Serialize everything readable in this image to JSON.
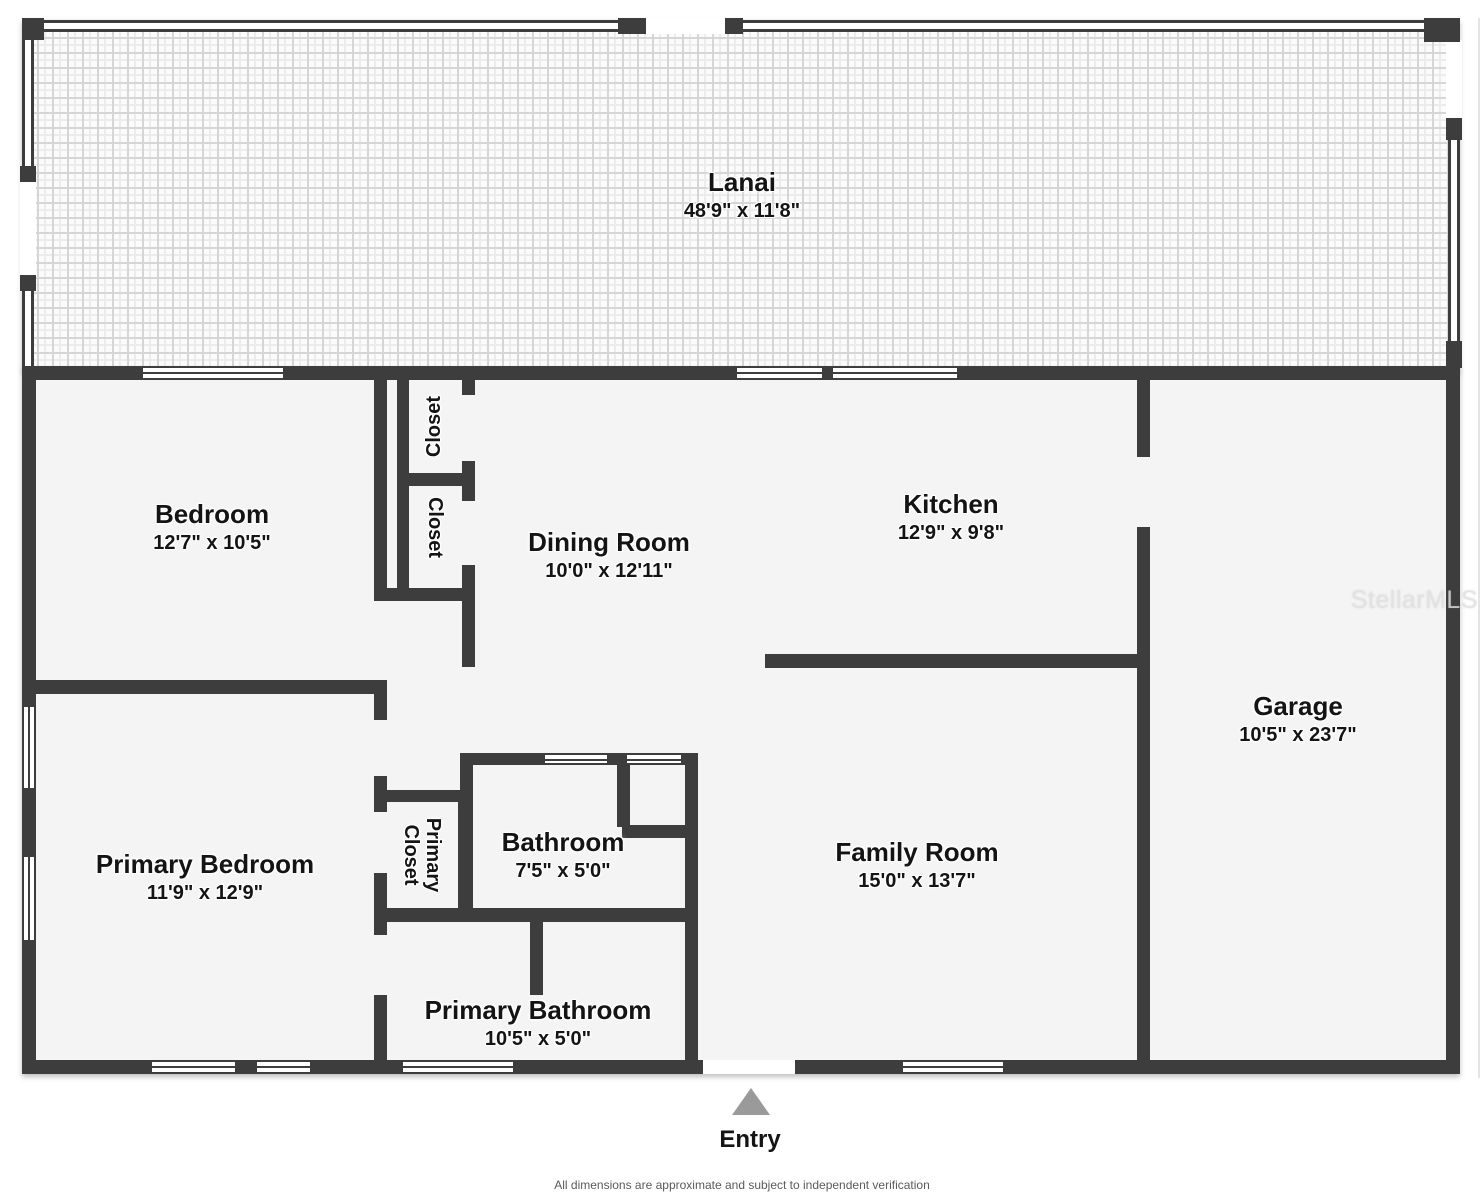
{
  "plan": {
    "watermark": "StellarMLS",
    "entry_label": "Entry",
    "disclaimer": "All dimensions are approximate and subject to independent verification"
  },
  "rooms": {
    "lanai": {
      "name": "Lanai",
      "dims": "48'9\" x 11'8\""
    },
    "bedroom": {
      "name": "Bedroom",
      "dims": "12'7\" x 10'5\""
    },
    "dining": {
      "name": "Dining Room",
      "dims": "10'0\" x 12'11\""
    },
    "kitchen": {
      "name": "Kitchen",
      "dims": "12'9\" x 9'8\""
    },
    "garage": {
      "name": "Garage",
      "dims": "10'5\" x 23'7\""
    },
    "primary_bedroom": {
      "name": "Primary Bedroom",
      "dims": "11'9\" x 12'9\""
    },
    "bathroom": {
      "name": "Bathroom",
      "dims": "7'5\" x 5'0\""
    },
    "family": {
      "name": "Family Room",
      "dims": "15'0\" x 13'7\""
    },
    "primary_bathroom": {
      "name": "Primary Bathroom",
      "dims": "10'5\" x 5'0\""
    },
    "closet_top": {
      "name": "Closet"
    },
    "closet_bottom": {
      "name": "Closet"
    },
    "primary_closet": {
      "name": "Primary Closet"
    }
  },
  "colors": {
    "wall": "#3d3d3d",
    "room_fill": "#f4f4f4",
    "entry_marker": "#9a9a9a"
  }
}
